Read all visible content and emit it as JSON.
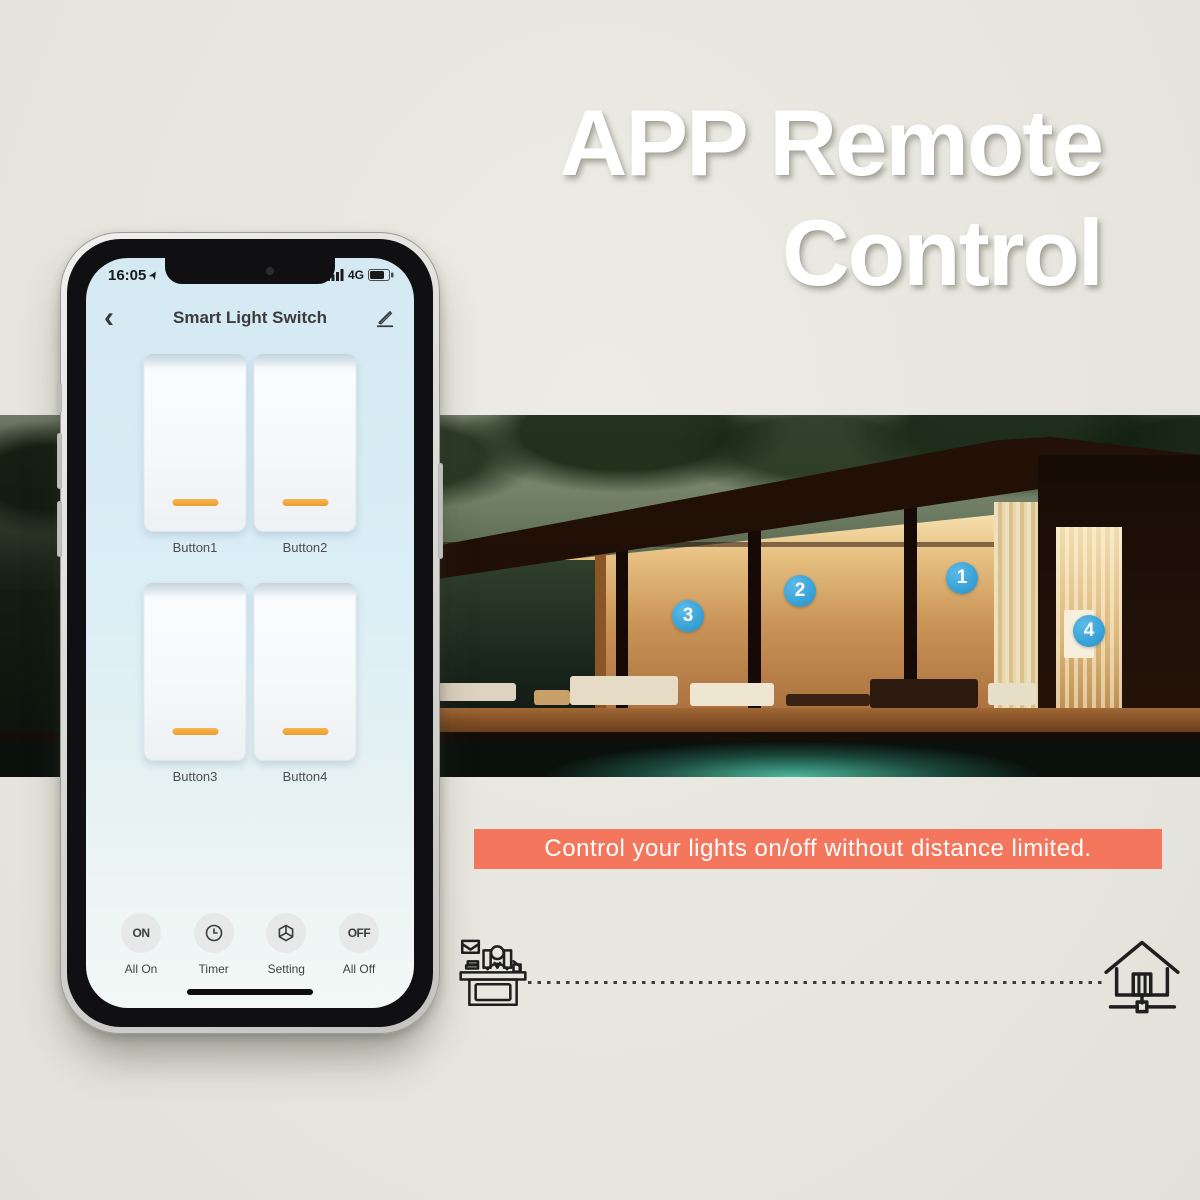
{
  "poster": {
    "headline": {
      "line1": "APP Remote",
      "line2": "Control"
    },
    "banner_text": "Control your lights on/off without distance limited.",
    "colors": {
      "background": "#e7e6de",
      "banner": "#f4765d",
      "marker_blue": "#3ba4d8",
      "switch_indicator_orange": "#efa83e",
      "headline_white": "#ffffff"
    },
    "footer_icons": {
      "left": "person-at-desk-icon",
      "right": "smart-home-network-icon"
    }
  },
  "phone": {
    "status_bar": {
      "time": "16:05",
      "network": "4G",
      "icons": [
        "location-arrow-icon",
        "signal-bars-icon",
        "battery-icon"
      ]
    },
    "header": {
      "title": "Smart Light Switch",
      "back_glyph": "‹",
      "icons": [
        "chevron-left-icon",
        "pencil-edit-icon"
      ]
    },
    "switches": [
      {
        "label": "Button1",
        "state": "off"
      },
      {
        "label": "Button2",
        "state": "off"
      },
      {
        "label": "Button3",
        "state": "off"
      },
      {
        "label": "Button4",
        "state": "off"
      }
    ],
    "toolbar": [
      {
        "icon": "on-text-icon",
        "text": "ON",
        "label": "All On"
      },
      {
        "icon": "clock-icon",
        "label": "Timer"
      },
      {
        "icon": "setting-box-icon",
        "label": "Setting"
      },
      {
        "icon": "off-text-icon",
        "text": "OFF",
        "label": "All Off"
      }
    ]
  },
  "photo": {
    "description": "modern glass house at night with pool",
    "markers": [
      {
        "number": "1"
      },
      {
        "number": "2"
      },
      {
        "number": "3"
      },
      {
        "number": "4"
      }
    ]
  }
}
